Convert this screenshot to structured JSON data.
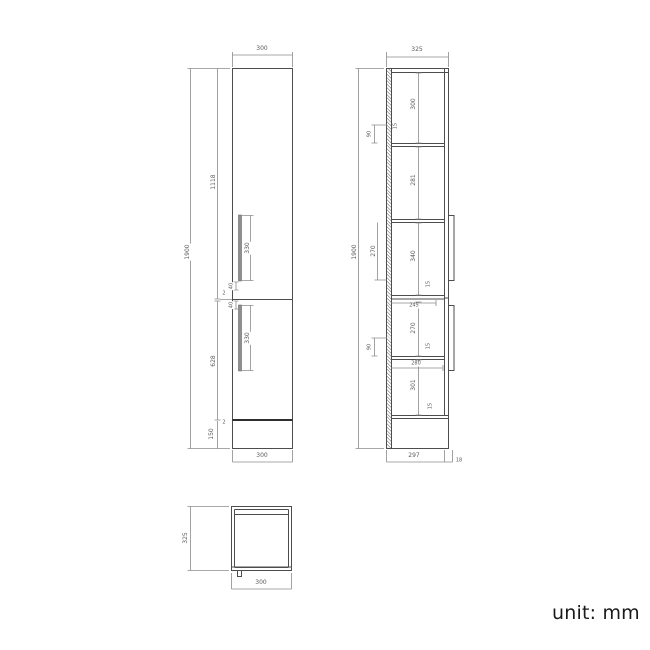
{
  "unit_label": "unit: mm",
  "front_view": {
    "dims": {
      "width_top": "300",
      "width_bottom": "300",
      "overall_height": "1900",
      "upper_door_height": "1118",
      "lower_door_height": "628",
      "plinth_height": "150",
      "door_gap_mid": "2",
      "door_gap_bottom": "2",
      "upper_handle_length": "330",
      "lower_handle_length": "330",
      "upper_handle_offset": "40",
      "lower_handle_offset": "40"
    }
  },
  "section_view": {
    "dims": {
      "depth_overall": "325",
      "overall_height": "1900",
      "compartments": [
        "300",
        "281",
        "340",
        "270",
        "301"
      ],
      "left_inner_height": "270",
      "shelf_thickness": [
        "15",
        "15",
        "15",
        "15"
      ],
      "back_brackets": [
        "90",
        "90"
      ],
      "shelf_depth_1": "245",
      "shelf_depth_2": "280",
      "carcass_depth": "297",
      "door_thickness": "18"
    }
  },
  "top_view": {
    "dims": {
      "depth": "325",
      "width": "300"
    }
  },
  "colors": {
    "outline": "#4d4d4d",
    "dimension": "#8c8c8c",
    "text": "#5a5a5a"
  }
}
